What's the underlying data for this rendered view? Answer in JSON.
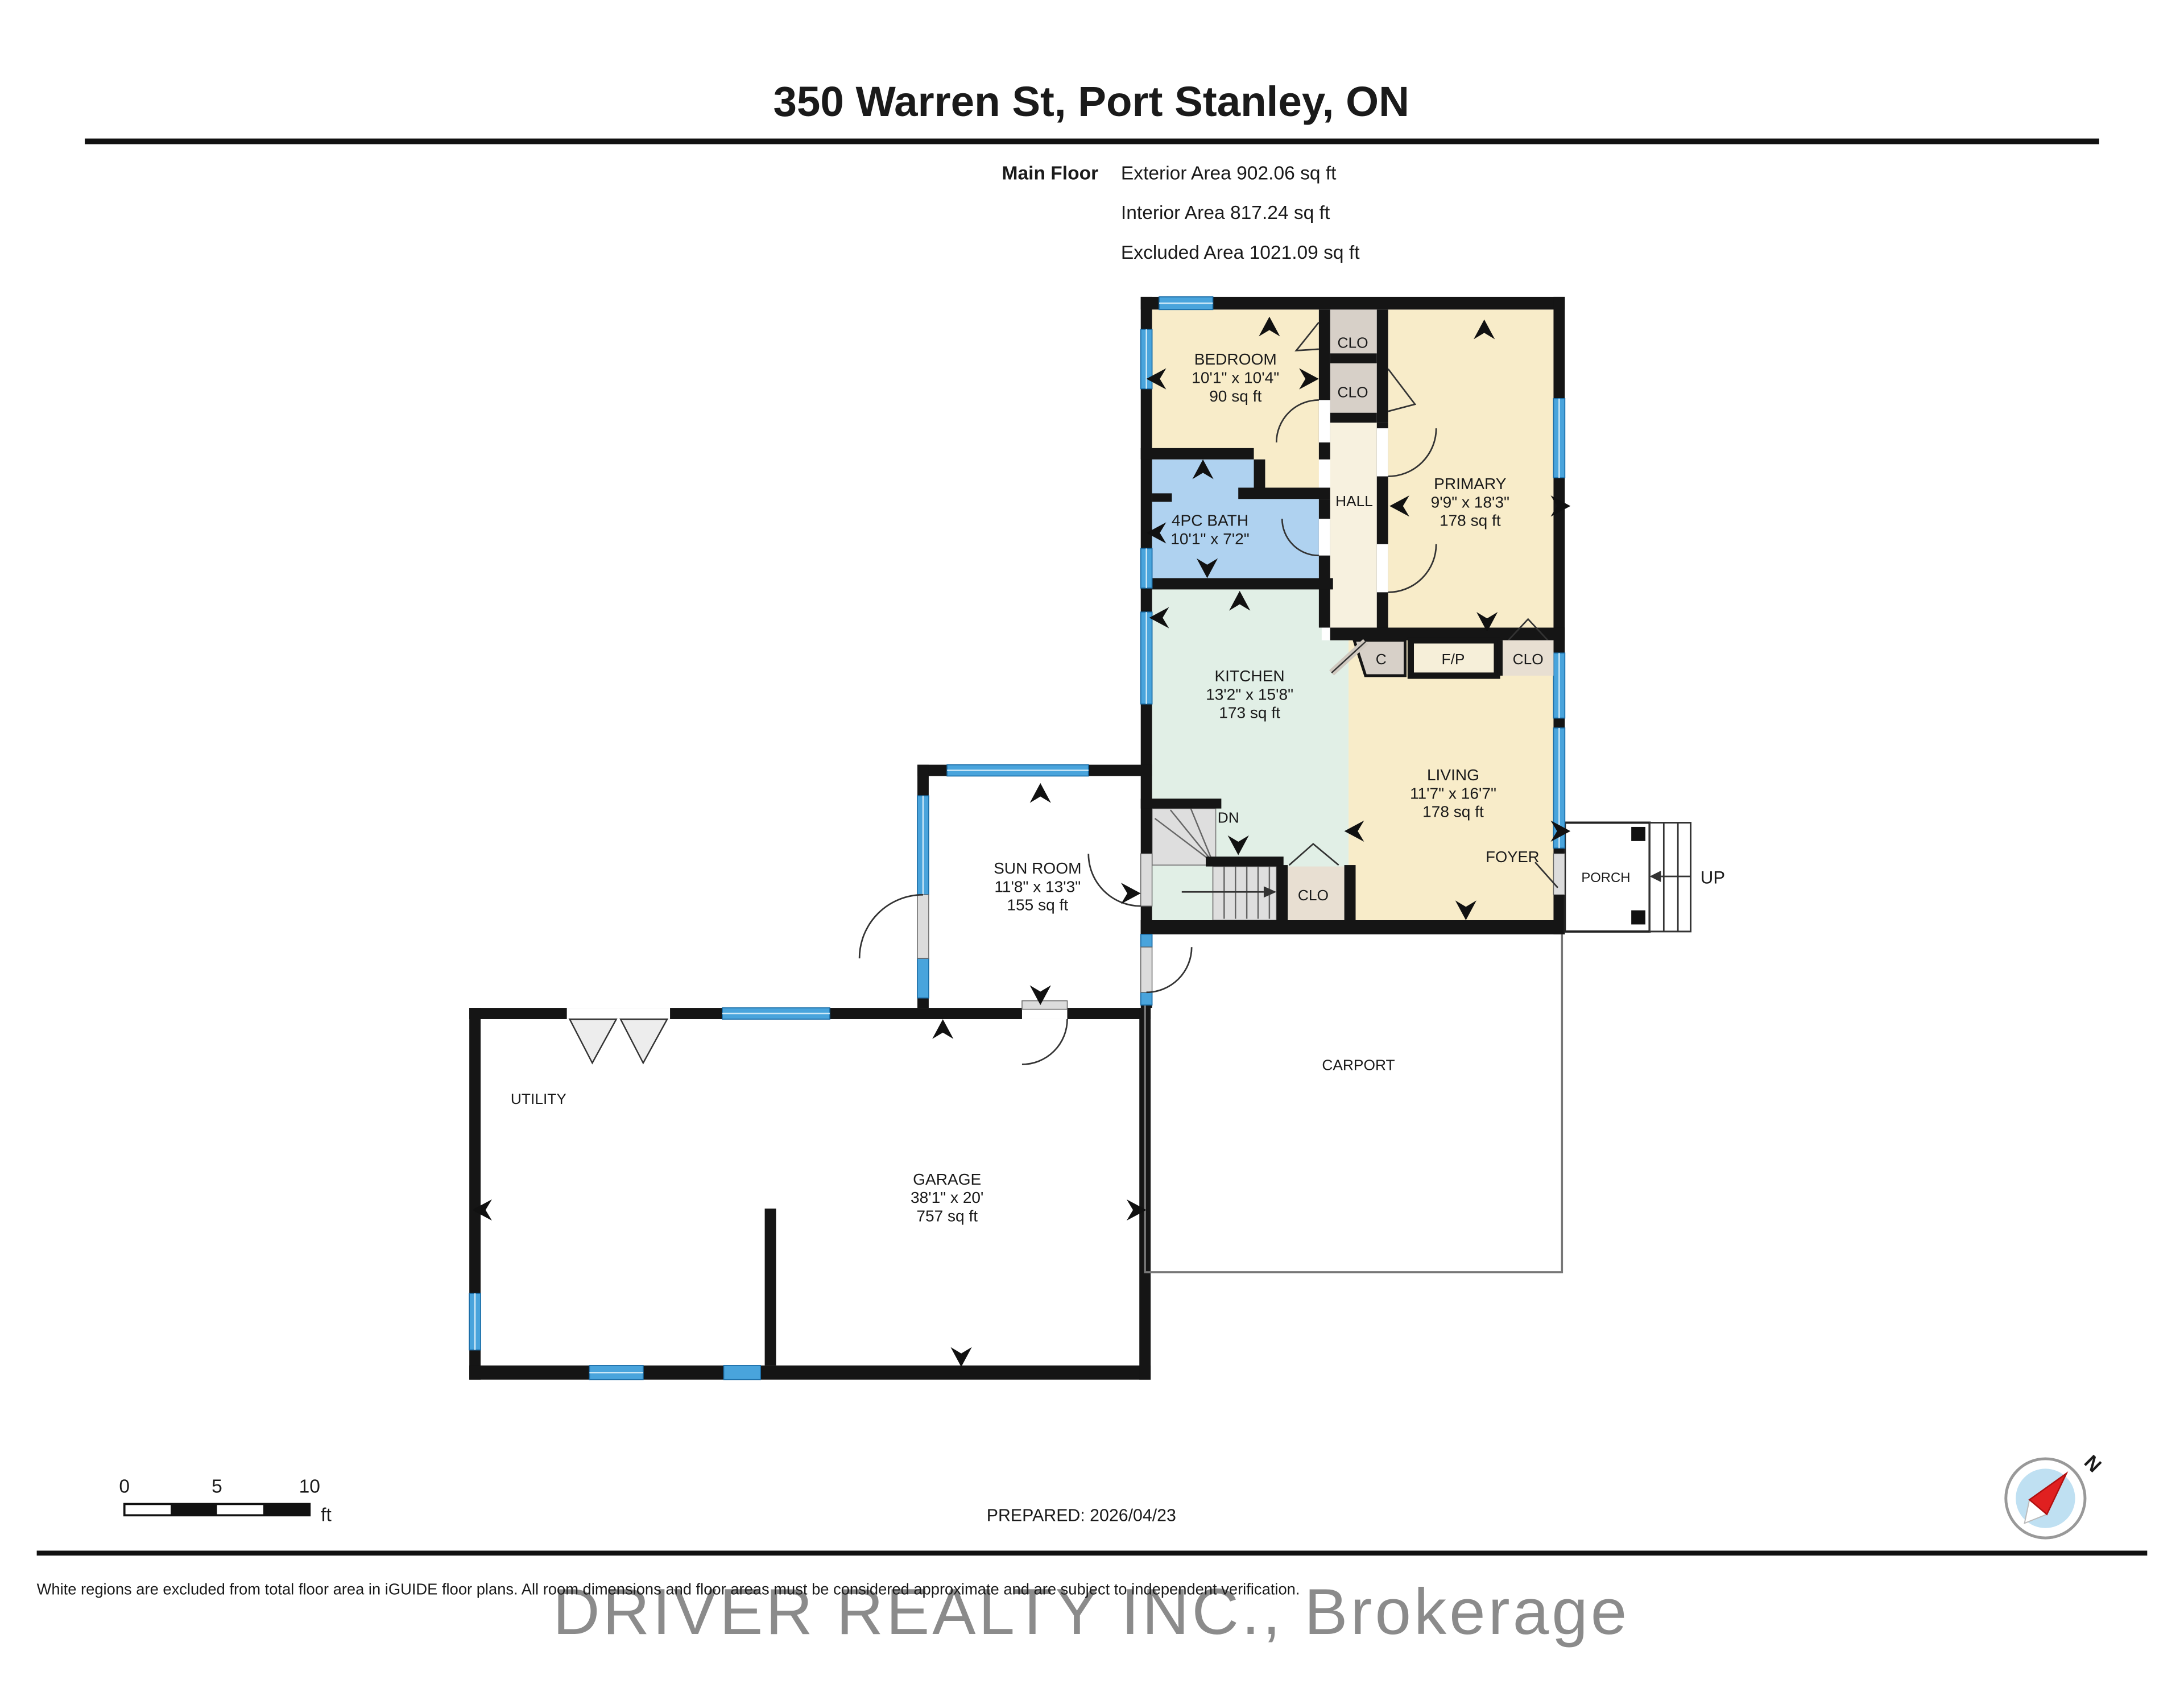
{
  "title": "350 Warren St, Port Stanley, ON",
  "summary": {
    "floor": "Main Floor",
    "exterior": "Exterior Area 902.06 sq ft",
    "interior": "Interior Area 817.24 sq ft",
    "excluded": "Excluded Area 1021.09 sq ft"
  },
  "rooms": {
    "bedroom": {
      "name": "BEDROOM",
      "dims": "10'1\" x 10'4\"",
      "area": "90 sq ft"
    },
    "primary": {
      "name": "PRIMARY",
      "dims": "9'9\" x 18'3\"",
      "area": "178 sq ft"
    },
    "bath": {
      "name": "4PC BATH",
      "dims": "10'1\" x 7'2\""
    },
    "kitchen": {
      "name": "KITCHEN",
      "dims": "13'2\" x 15'8\"",
      "area": "173 sq ft"
    },
    "living": {
      "name": "LIVING",
      "dims": "11'7\" x 16'7\"",
      "area": "178 sq ft"
    },
    "sunroom": {
      "name": "SUN ROOM",
      "dims": "11'8\" x 13'3\"",
      "area": "155 sq ft"
    },
    "garage": {
      "name": "GARAGE",
      "dims": "38'1\" x 20'",
      "area": "757 sq ft"
    }
  },
  "labels": {
    "clo": "CLO",
    "hall": "HALL",
    "c": "C",
    "fp": "F/P",
    "dn": "DN",
    "up": "UP",
    "utility": "UTILITY",
    "carport": "CARPORT",
    "porch": "PORCH",
    "foyer": "FOYER"
  },
  "scale_bar": {
    "zero": "0",
    "five": "5",
    "ten": "10",
    "unit": "ft"
  },
  "footer": {
    "prepared": "PREPARED: 2026/04/23",
    "disclaimer": "White regions are excluded from total floor area in iGUIDE floor plans. All room dimensions and floor areas must be considered approximate and are subject to independent verification.",
    "watermark": "DRIVER REALTY INC., Brokerage"
  },
  "compass": {
    "north": "N"
  },
  "colors": {
    "room_cream": "#F8ECC9",
    "hall_cream": "#F7F1DF",
    "bath_blue": "#AFD2F0",
    "kitchen_mint": "#E1EFE6",
    "closet_gray": "#D7D0C8",
    "closet_beige": "#E8DFD2",
    "window_blue": "#49A4DC",
    "wall_black": "#151515",
    "compass_red": "#E02020",
    "compass_blue": "#BFE0F2"
  }
}
